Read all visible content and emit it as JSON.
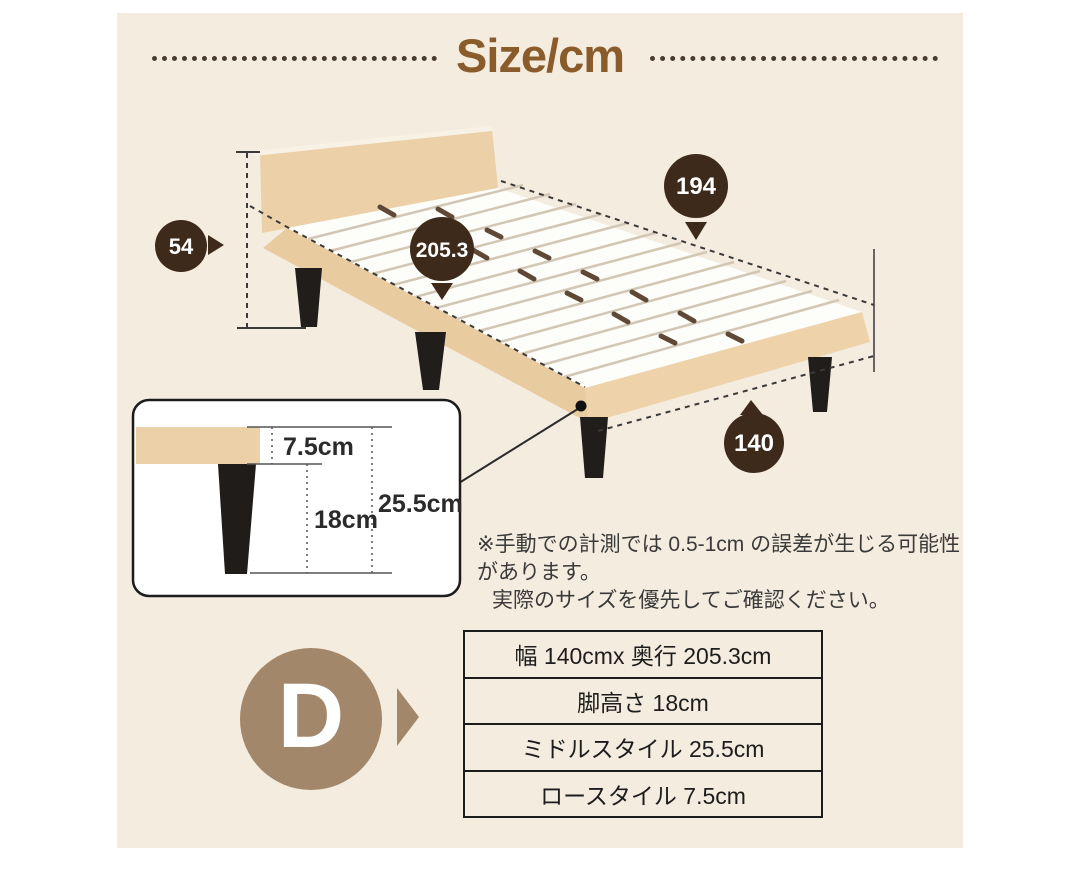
{
  "title": {
    "text": "Size/cm"
  },
  "dimensions": {
    "length_inner": {
      "value": "194"
    },
    "length_total": {
      "value": "205.3"
    },
    "headboard_height": {
      "value": "54"
    },
    "width": {
      "value": "140"
    }
  },
  "leg_detail": {
    "frame_thickness": "7.5cm",
    "leg_height": "18cm",
    "total_height": "25.5cm"
  },
  "note": {
    "line1": "※手動での計測では 0.5-1cm の誤差が生じる可能性があります。",
    "line2": "実際のサイズを優先してご確認ください。"
  },
  "size_class": {
    "letter": "D"
  },
  "spec_table": {
    "rows": [
      "幅 140cmx 奥行 205.3cm",
      "脚高さ 18cm",
      "ミドルスタイル 25.5cm",
      "ロースタイル 7.5cm"
    ]
  },
  "colors": {
    "panel_bg": "#f4ecdf",
    "title_brown": "#8a5c2c",
    "badge_dark": "#3e2a1b",
    "badge_light": "#a3876a",
    "wood_tan": "#ecd0a7",
    "leg_black": "#201d1a"
  }
}
